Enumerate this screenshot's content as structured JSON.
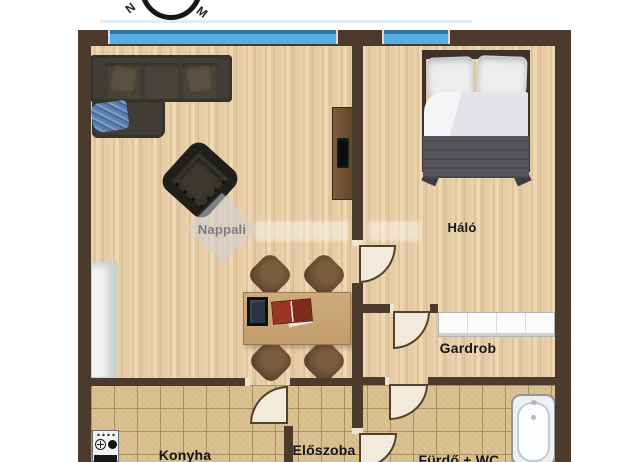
{
  "document": {
    "type": "apartment-floor-plan"
  },
  "compass": {
    "left_label": "N",
    "right_label": "M"
  },
  "rooms": {
    "nappali": {
      "label": "Nappali"
    },
    "halo": {
      "label": "Háló"
    },
    "gardrob": {
      "label": "Gardrob"
    },
    "konyha": {
      "label": "Konyha"
    },
    "eloszoba": {
      "label": "Előszoba"
    },
    "furdo_wc": {
      "label": "Fürdő + WC"
    }
  },
  "objects": [
    "sofa",
    "blue-blanket",
    "armchair",
    "tv-cabinet",
    "white-cabinet",
    "dining-table",
    "chairs",
    "photo-frame",
    "red-book",
    "double-bed",
    "wardrobe",
    "bathtub",
    "stove",
    "doors",
    "windows",
    "compass",
    "watermark"
  ],
  "colors": {
    "wall": "#4c3b2c",
    "wood_floor": "#e4cba4",
    "tile_floor": "#d8bd8c",
    "window_blue": "#59ade0",
    "window_blue_dark": "#2d76aa",
    "door_leaf": "#f2ebdb",
    "sofa": "#403d37",
    "bed_blanket": "#56555b",
    "label_text": "#151515"
  }
}
